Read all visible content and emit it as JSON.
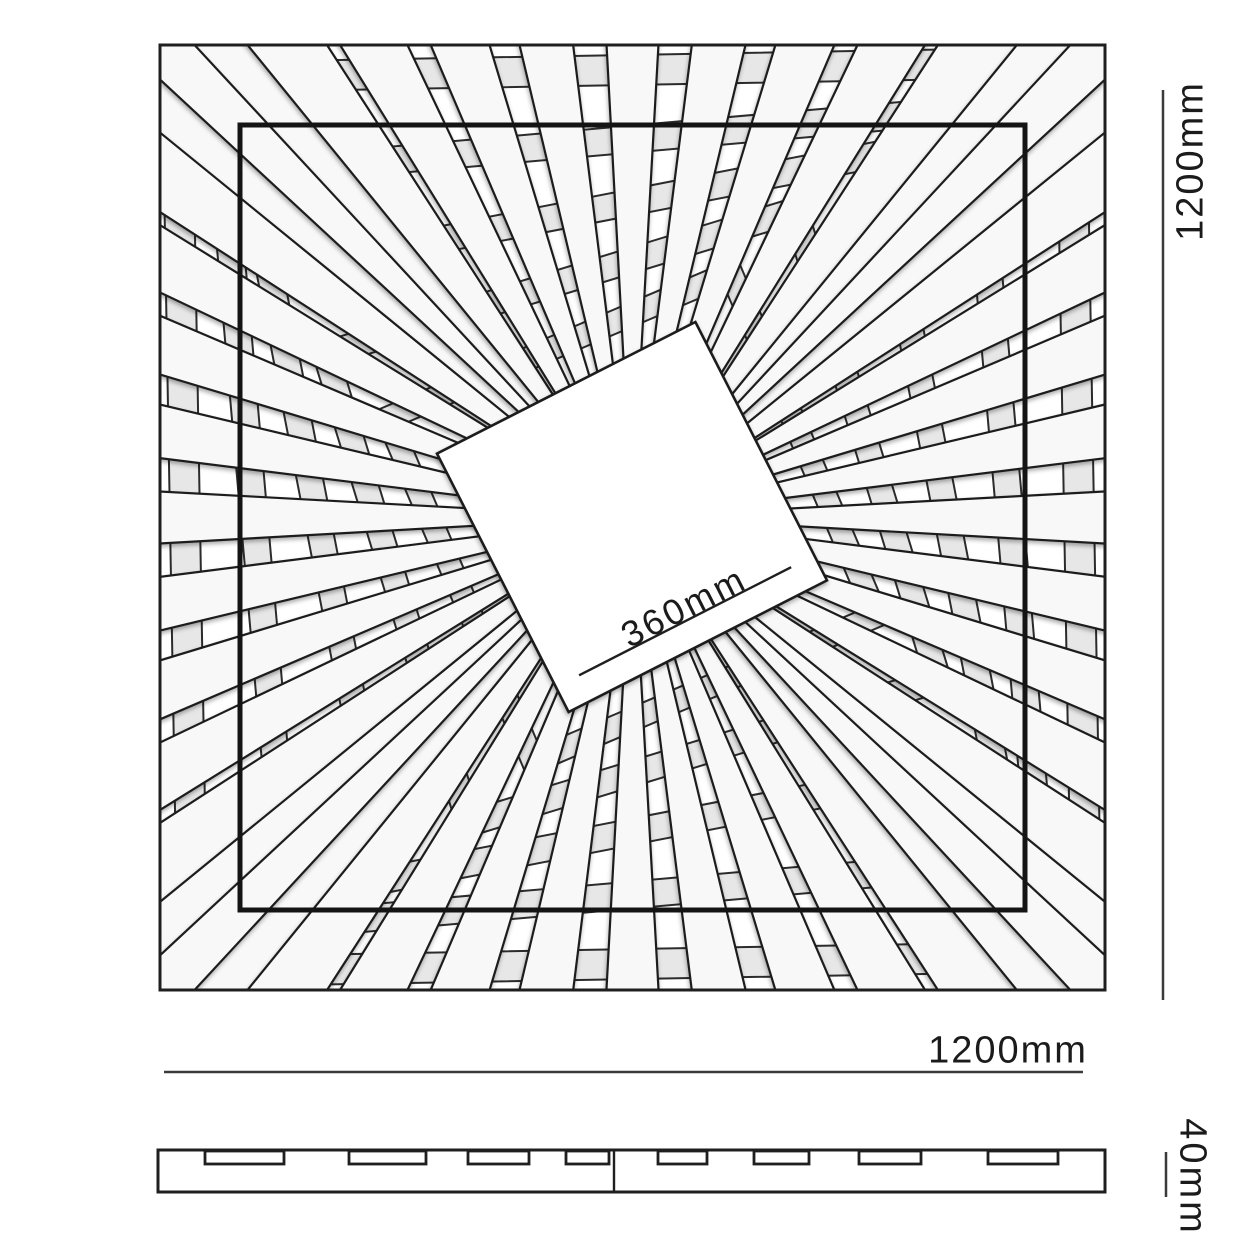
{
  "figure": {
    "type": "technical-drawing",
    "subject": "square slatted ceiling panel, top view and side profile",
    "units": "mm"
  },
  "labels": {
    "panel_height": "1200mm",
    "panel_width": "1200mm",
    "center_square": "360mm",
    "thickness": "40mm"
  },
  "colors": {
    "background": "#ffffff",
    "line": "#1f1f1f",
    "bold_line": "#141414",
    "slat_fill": "#f8f8f8",
    "ring_fill": "#e7e7e7",
    "ring_line": "#2b2b2b",
    "dim_line": "#3a3a3a",
    "text": "#1b1b1b"
  },
  "top_view": {
    "frame": {
      "x": 160,
      "y": 45,
      "w": 945,
      "h": 945
    },
    "inner_frame": {
      "x": 240,
      "y": 125,
      "w": 785,
      "h": 785
    },
    "center": {
      "x": 632,
      "y": 517
    },
    "center_square": {
      "side": 290,
      "rotation_deg": -27,
      "band_inset": 28,
      "band_trim": 26
    },
    "slats": {
      "per_side": 11,
      "inner_radius": 125,
      "half_angle_tan": 0.055,
      "corner_half_angle_tan": 0.038,
      "overshoot": 60
    },
    "rings": [
      {
        "half": 462,
        "rot": -1,
        "width": 30
      },
      {
        "half": 390,
        "rot": -5,
        "width": 27
      },
      {
        "half": 322,
        "rot": -11,
        "width": 26
      },
      {
        "half": 258,
        "rot": -17,
        "width": 25
      },
      {
        "half": 198,
        "rot": -23,
        "width": 23
      }
    ]
  },
  "dimensions": {
    "right_line": {
      "x": 1163,
      "y1": 90,
      "y2": 1000
    },
    "bottom_line": {
      "x1": 164,
      "x2": 1083,
      "y": 1072
    },
    "thickness_line": {
      "x": 1166,
      "y1": 1152,
      "y2": 1197
    }
  },
  "side_view": {
    "rect": {
      "x": 158,
      "y": 1150,
      "w": 947,
      "h": 42
    },
    "divider_x": 614,
    "notch_y": 1151,
    "notch_h": 13,
    "notches": [
      {
        "x": 205,
        "w": 79
      },
      {
        "x": 349,
        "w": 77
      },
      {
        "x": 468,
        "w": 61
      },
      {
        "x": 566,
        "w": 43
      },
      {
        "x": 658,
        "w": 49
      },
      {
        "x": 754,
        "w": 55
      },
      {
        "x": 859,
        "w": 62
      },
      {
        "x": 988,
        "w": 70
      }
    ]
  }
}
